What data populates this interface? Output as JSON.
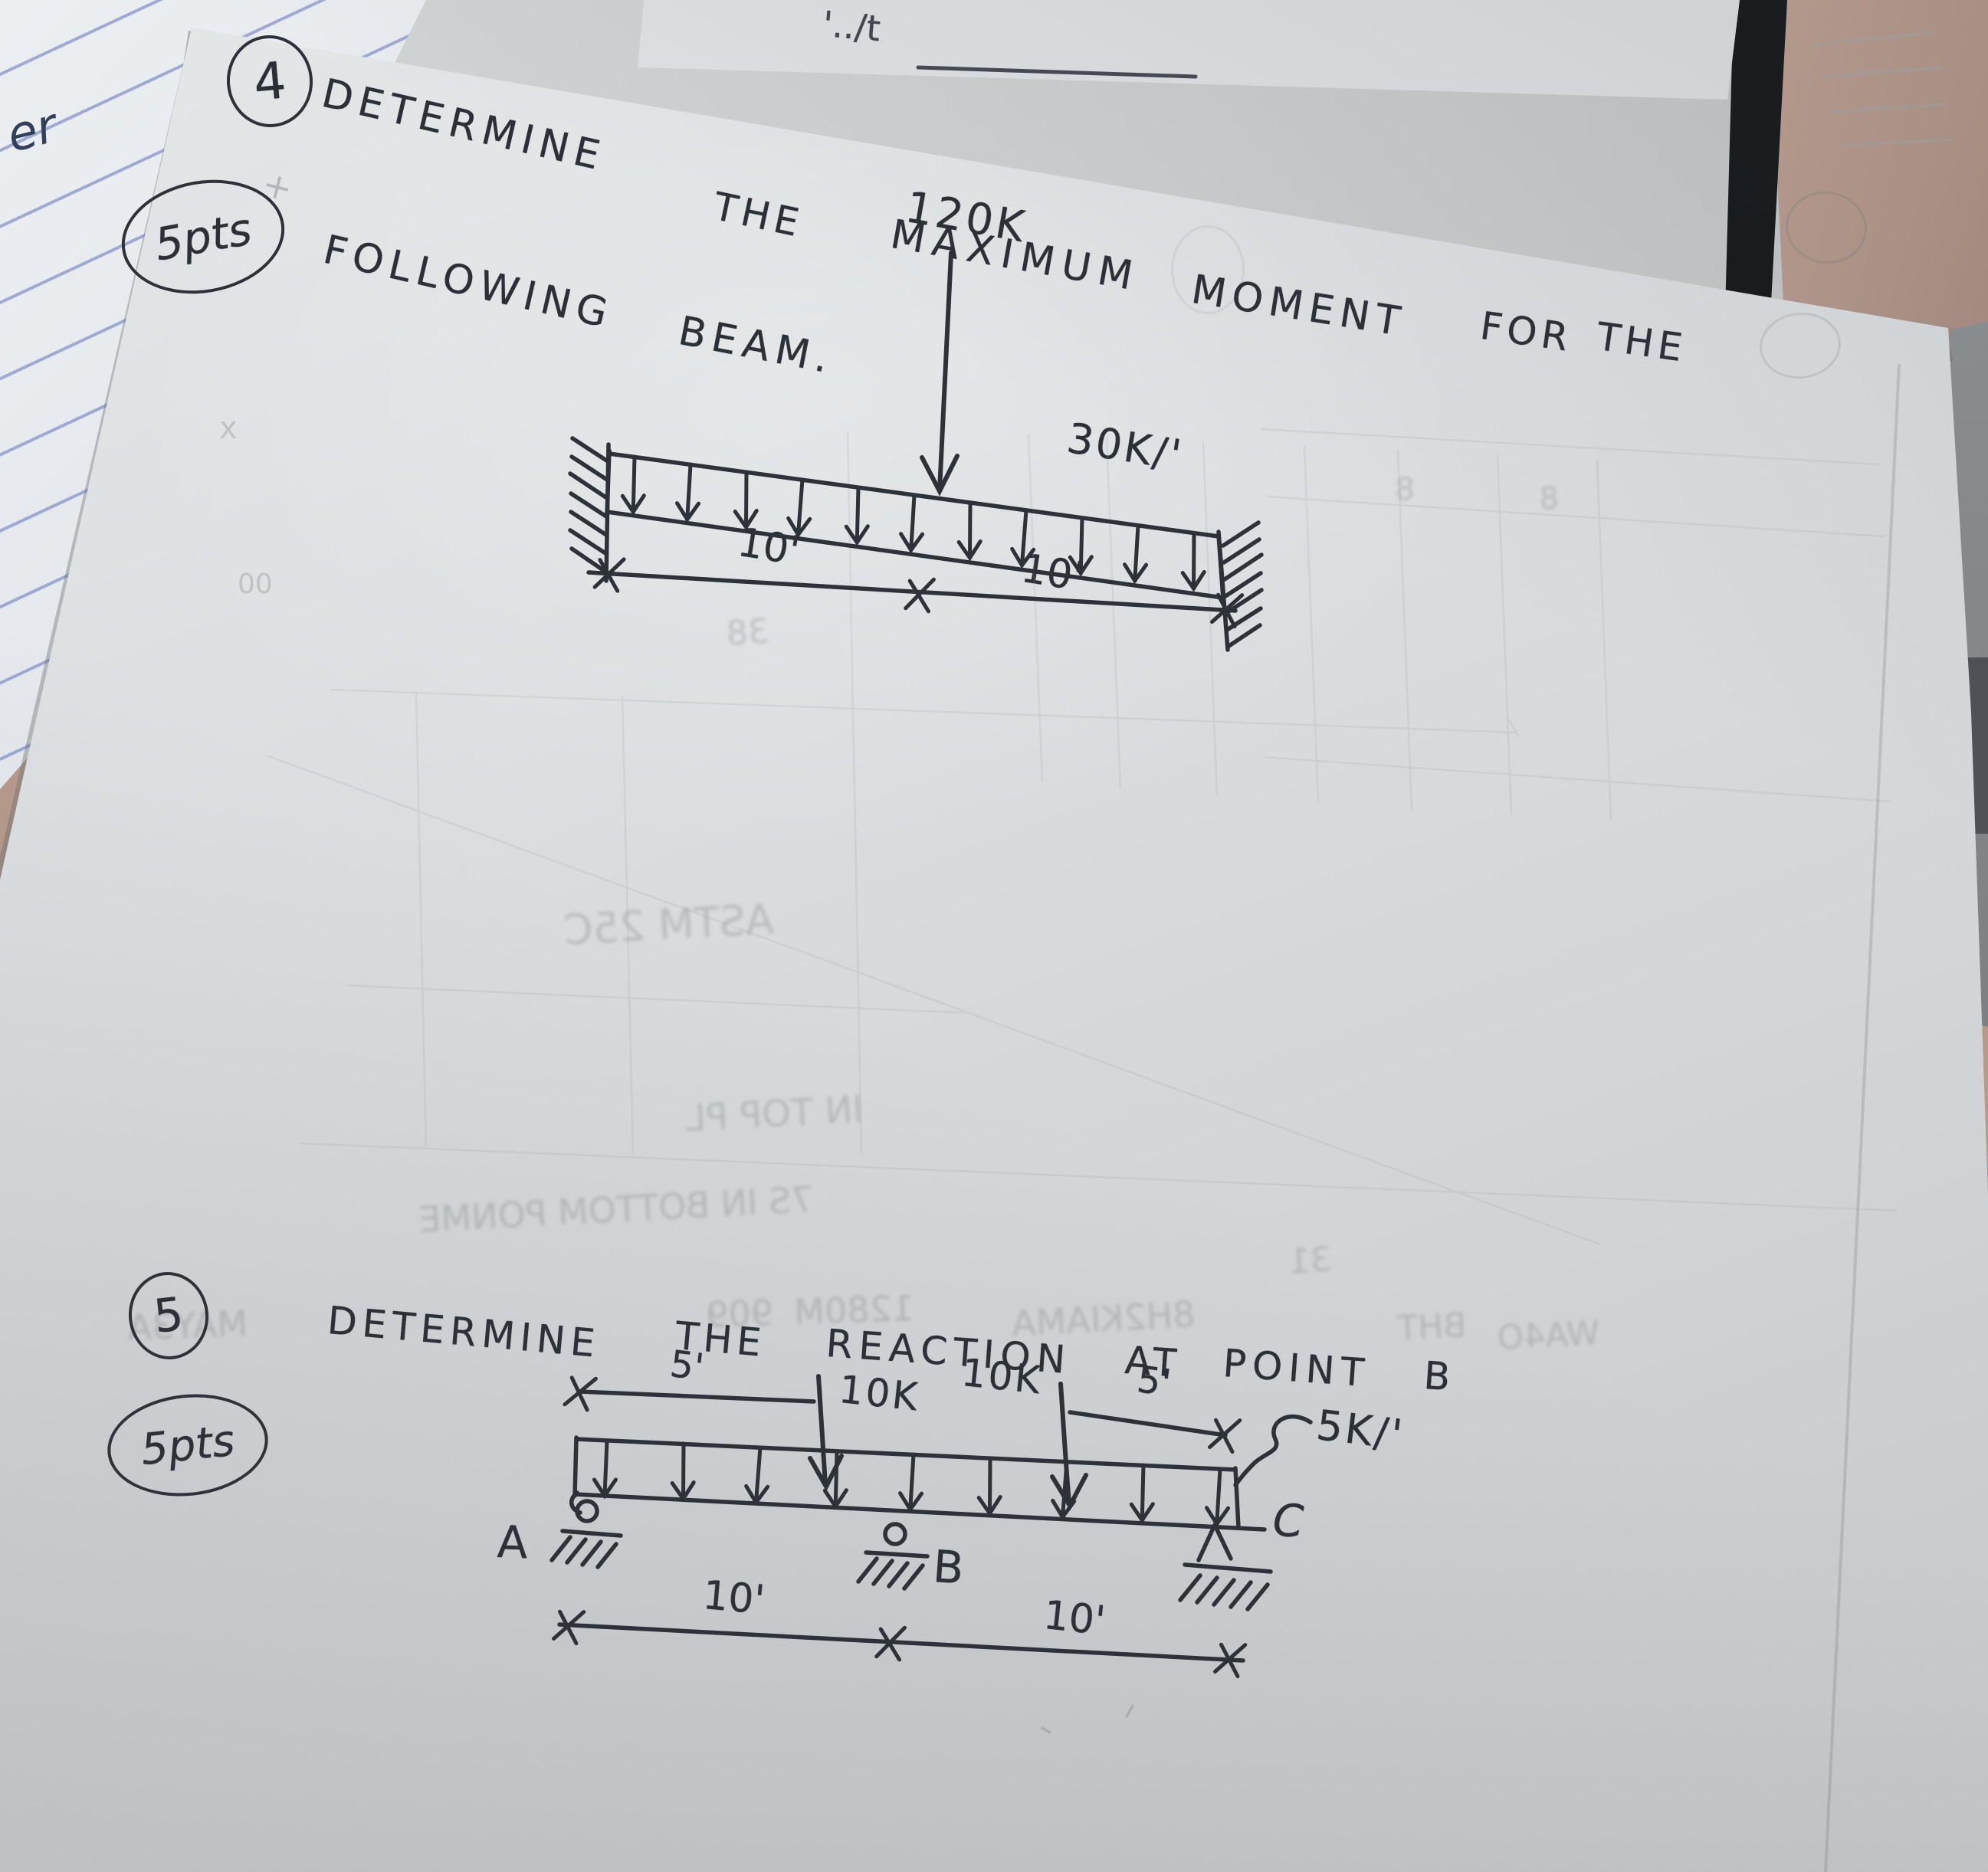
{
  "problem4": {
    "number": "4",
    "points": "5pts",
    "title1": [
      "DETERMINE",
      "THE",
      "MAXIMUM",
      "MOMENT",
      "FOR",
      "THE"
    ],
    "title2": [
      "FOLLOWING",
      "BEAM."
    ],
    "beam": {
      "point_load": "120K",
      "udl": "30K/'",
      "dim1": "10'",
      "dim2": "10'"
    }
  },
  "problem5": {
    "number": "5",
    "points": "5pts",
    "title": [
      "DETERMINE",
      "THE",
      "REACTION",
      "AT",
      "POINT",
      "B"
    ],
    "beam": {
      "load1": "10K",
      "load2": "10K",
      "udl": "5K/'",
      "top_dim1": "5'",
      "top_dim2": "5'",
      "bot_dim1": "10'",
      "bot_dim2": "10'",
      "supportA": "A",
      "supportB": "B",
      "supportC": "C"
    }
  },
  "surroundings": {
    "notebook_scribble": "er",
    "top_scribble": "'../t"
  },
  "ghost": {
    "texts": [
      "MAY3A",
      "909",
      "1280M",
      "8H2KIAMA",
      "BHT",
      "WA4O",
      "ASTM 25C",
      "IN TOP PL",
      "7S IN BOTTOM PONME",
      "8",
      "8",
      "38",
      "31"
    ],
    "marks": [
      "+",
      "x",
      "00"
    ]
  }
}
